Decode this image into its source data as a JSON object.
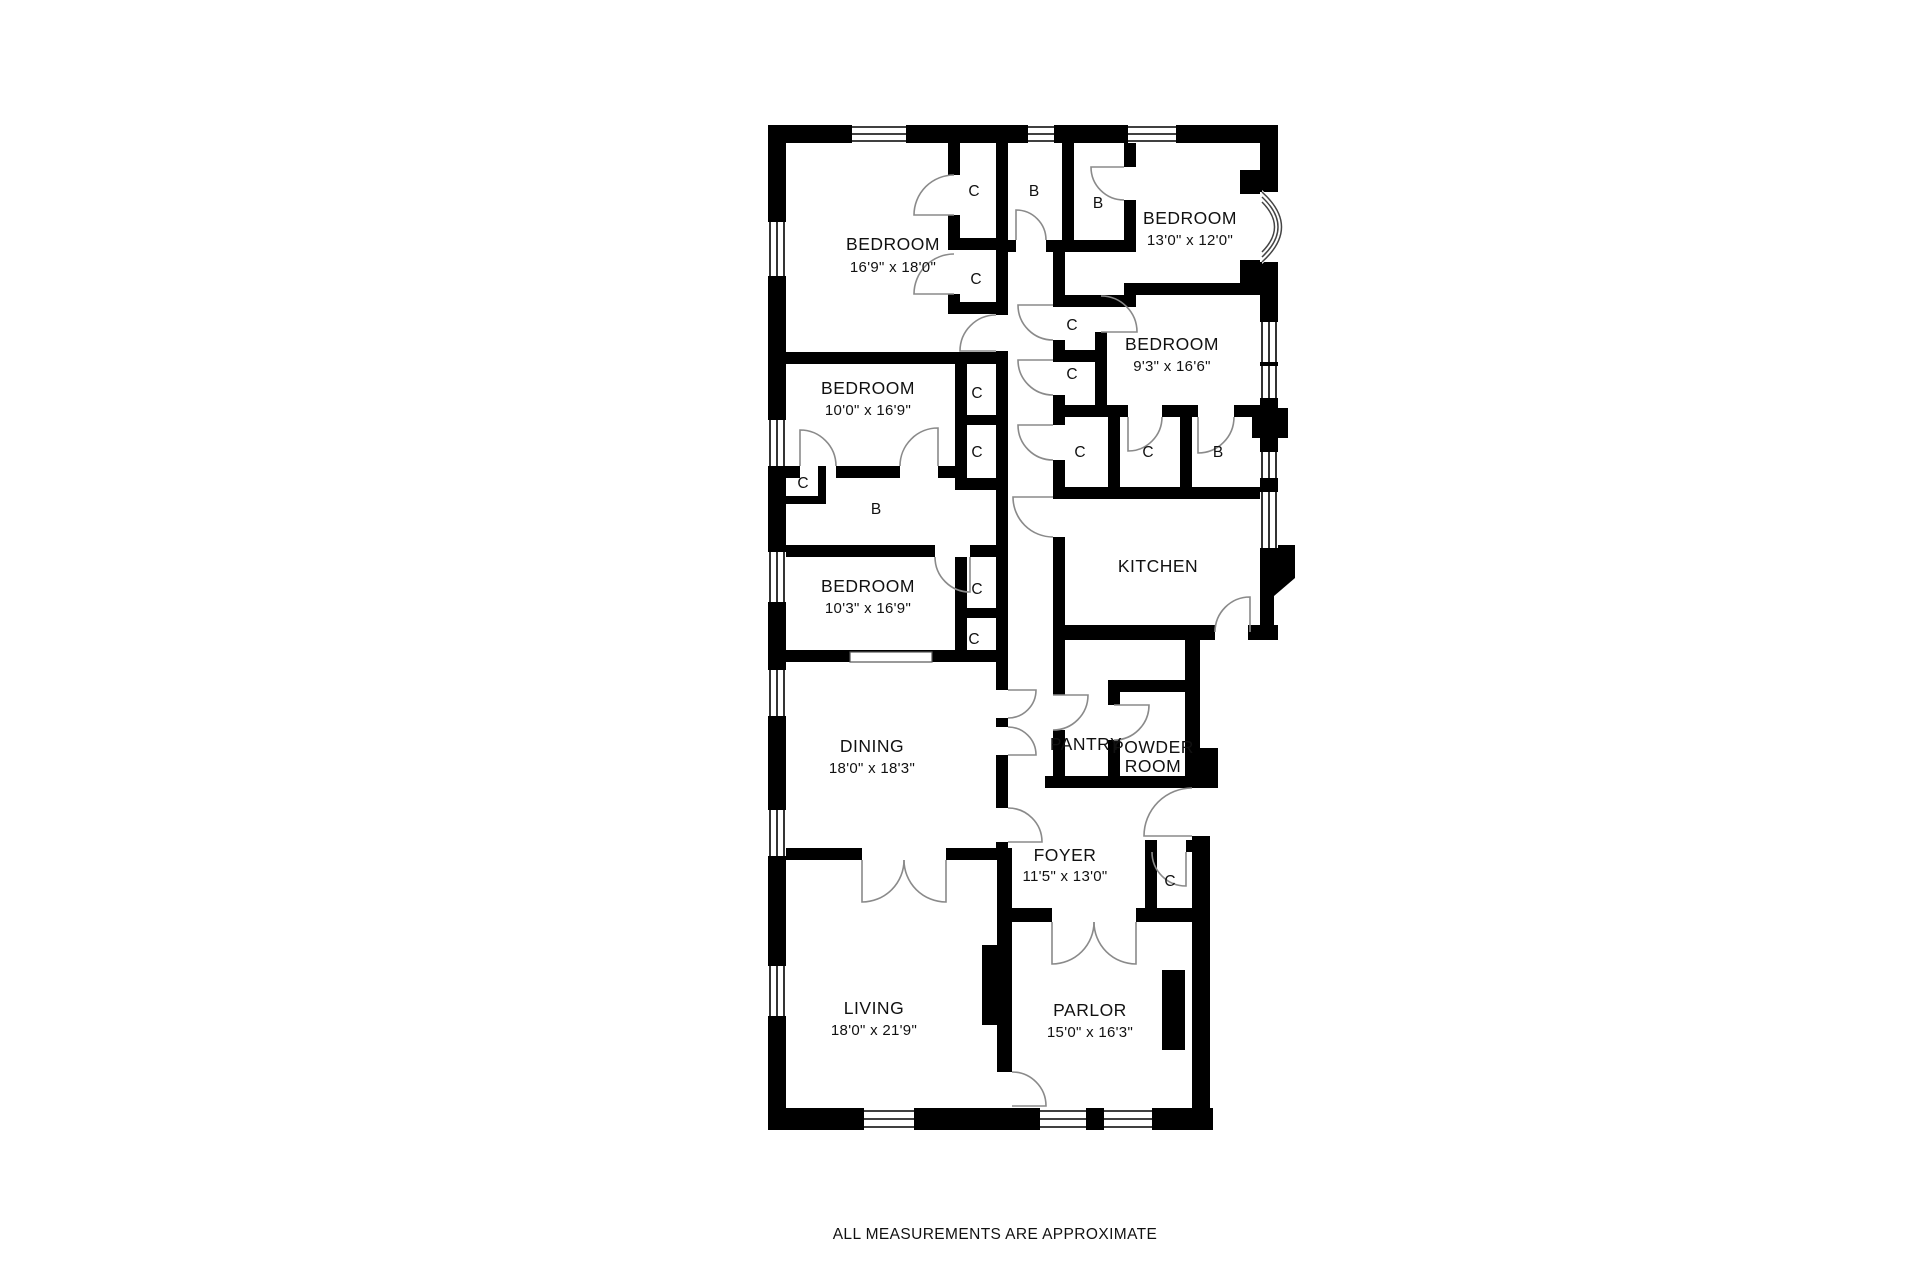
{
  "plan": {
    "rooms": {
      "bedroom_top_left": {
        "name": "BEDROOM",
        "dims": "16'9\" x 18'0\""
      },
      "bedroom_top_right": {
        "name": "BEDROOM",
        "dims": "13'0\" x 12'0\""
      },
      "bedroom_right": {
        "name": "BEDROOM",
        "dims": "9'3\" x 16'6\""
      },
      "bedroom_mid_upper": {
        "name": "BEDROOM",
        "dims": "10'0\" x 16'9\""
      },
      "bedroom_mid_lower": {
        "name": "BEDROOM",
        "dims": "10'3\" x 16'9\""
      },
      "kitchen": {
        "name": "KITCHEN"
      },
      "dining": {
        "name": "DINING",
        "dims": "18'0\" x 18'3\""
      },
      "pantry": {
        "name": "PANTRY"
      },
      "powder_room": {
        "line1": "POWDER",
        "line2": "ROOM"
      },
      "foyer": {
        "name": "FOYER",
        "dims": "11'5\" x 13'0\""
      },
      "living": {
        "name": "LIVING",
        "dims": "18'0\" x 21'9\""
      },
      "parlor": {
        "name": "PARLOR",
        "dims": "15'0\" x 16'3\""
      }
    },
    "markers": {
      "closet": "C",
      "bath": "B"
    },
    "colors": {
      "wall": "#000000",
      "door_arc": "#8a8a8a",
      "background": "#ffffff"
    },
    "note": "ALL MEASUREMENTS ARE APPROXIMATE"
  }
}
